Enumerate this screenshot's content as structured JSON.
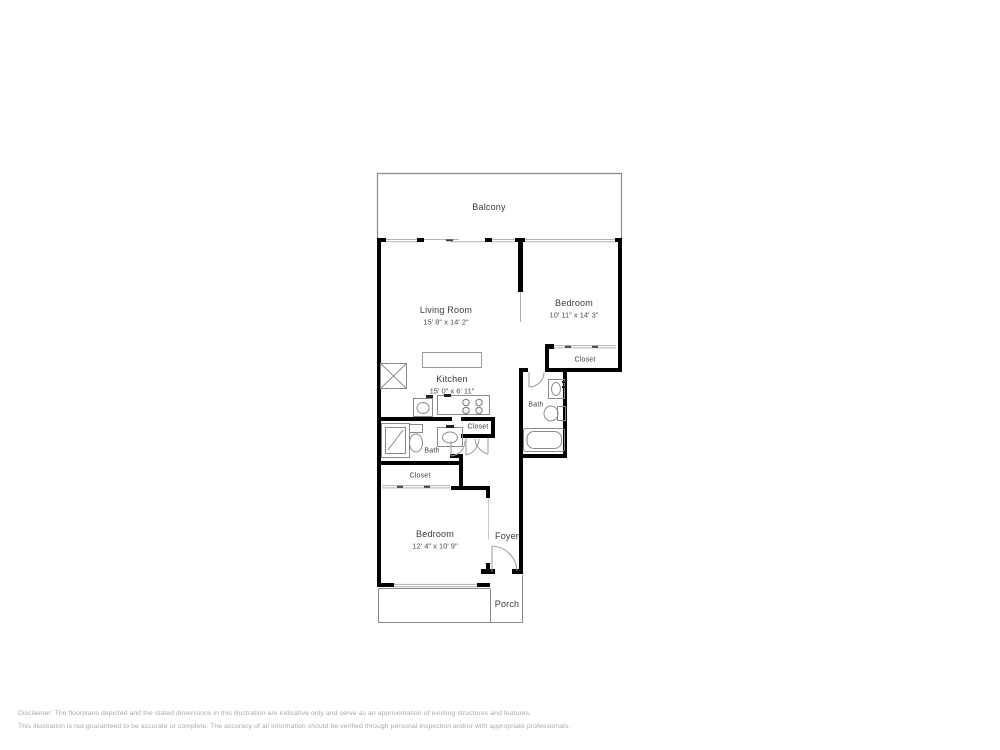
{
  "rooms": {
    "balcony": {
      "label": "Balcony"
    },
    "living_room": {
      "label": "Living Room",
      "dimensions": "15' 8\" x 14' 2\""
    },
    "bedroom_right": {
      "label": "Bedroom",
      "dimensions": "10' 11\" x 14' 3\""
    },
    "closet_bedroom": {
      "label": "Closet"
    },
    "kitchen": {
      "label": "Kitchen",
      "dimensions": "15' 0\" x 6' 11\""
    },
    "bath_right": {
      "label": "Bath"
    },
    "closet_hall": {
      "label": "Closet"
    },
    "bath_left": {
      "label": "Bath"
    },
    "closet_lower": {
      "label": "Closet"
    },
    "bedroom_lower": {
      "label": "Bedroom",
      "dimensions": "12' 4\" x 10' 9\""
    },
    "foyer": {
      "label": "Foyer"
    },
    "porch": {
      "label": "Porch"
    }
  },
  "disclaimer": {
    "line1": "Disclaimer: The floorplans depicted and the stated dimensions in this illustration are indicative only and serve as an approximation of existing structures and features.",
    "line2": "This illustration is not guaranteed to be accurate or complete. The accuracy of all information should be verified through personal inspection and/or with appropriate professionals."
  },
  "colors": {
    "wall": "#000000",
    "thin_line": "#8a8a8a",
    "window_line": "#b3b3b3",
    "fixture_line": "#8a8a8a",
    "label_text": "#3a3a3a",
    "disclaimer_text": "#a9a9a9",
    "background": "#ffffff"
  }
}
